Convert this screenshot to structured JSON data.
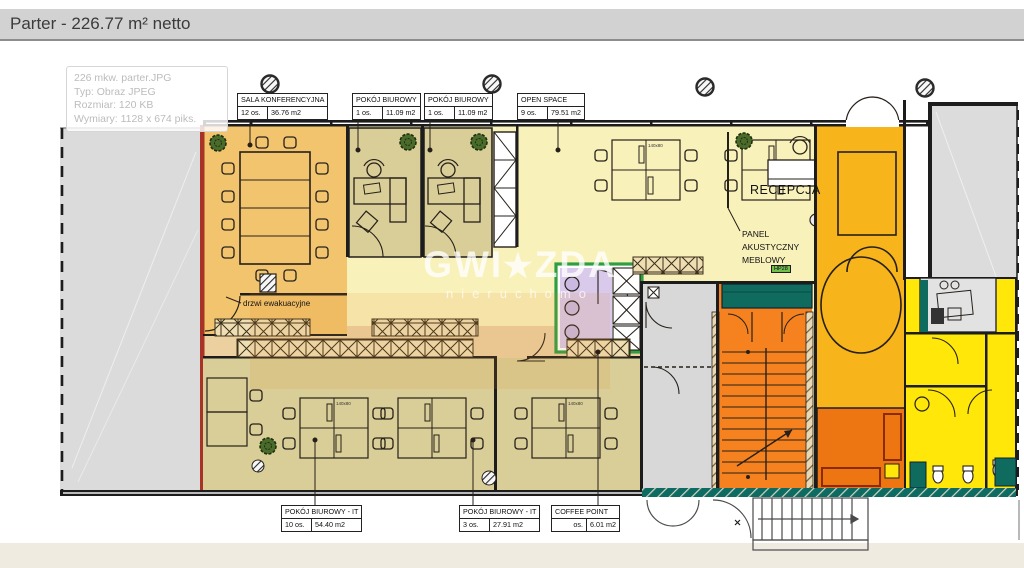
{
  "title": "Parter - 226.77 m² netto",
  "image_tooltip": {
    "filename": "226 mkw. parter.JPG",
    "type": "Typ: Obraz JPEG",
    "size": "Rozmiar: 120 KB",
    "dimensions": "Wymiary: 1128 x 674 piks."
  },
  "watermark": {
    "brand_left": "GWI",
    "brand_star": "★",
    "brand_right": "ZDA",
    "subtitle": "nieruchomo"
  },
  "room_labels": {
    "conference": {
      "name": "SALA KONFERENCYJNA",
      "occupancy": "12 os.",
      "area": "36.76 m2"
    },
    "office1": {
      "name": "POKÓJ BIUROWY",
      "occupancy": "1 os.",
      "area": "11.09 m2"
    },
    "office2": {
      "name": "POKÓJ BIUROWY",
      "occupancy": "1 os.",
      "area": "11.09 m2"
    },
    "open_space": {
      "name": "OPEN SPACE",
      "occupancy": "9 os.",
      "area": "79.51 m2"
    },
    "office_it10": {
      "name": "POKÓJ BIUROWY - IT",
      "occupancy": "10 os.",
      "area": "54.40 m2"
    },
    "office_it3": {
      "name": "POKÓJ BIUROWY - IT",
      "occupancy": "3 os.",
      "area": "27.91 m2"
    },
    "coffee": {
      "name": "COFFEE POINT",
      "occupancy": "os.",
      "area": "6.01 m2"
    }
  },
  "annotations": {
    "reception": "RECEPCJA",
    "acoustic_panel": "PANEL AKUSTYCZNY MEBLOWY",
    "evacuation_door": "drzwi ewakuacyjne",
    "desk_size_tag": "140x80",
    "hp_tag": "HP28"
  },
  "palette": {
    "title_bar": "#d2d2d2",
    "conference_room": "#f2c46d",
    "small_office": "#d9ce97",
    "open_space": "#f8f1ba",
    "corridor": "#ecd0a0",
    "coffee_point": "#d9c9ea",
    "coffee_border": "#2f9e41",
    "stairwell": "#f5821f",
    "entrance_hall": "#f7b51b",
    "utility_room": "#ee7612",
    "toilets": "#ffe70a",
    "teal_furniture": "#0e6b5e",
    "neighbor_area": "#dbdbdb",
    "red_wall": "#a93226"
  }
}
